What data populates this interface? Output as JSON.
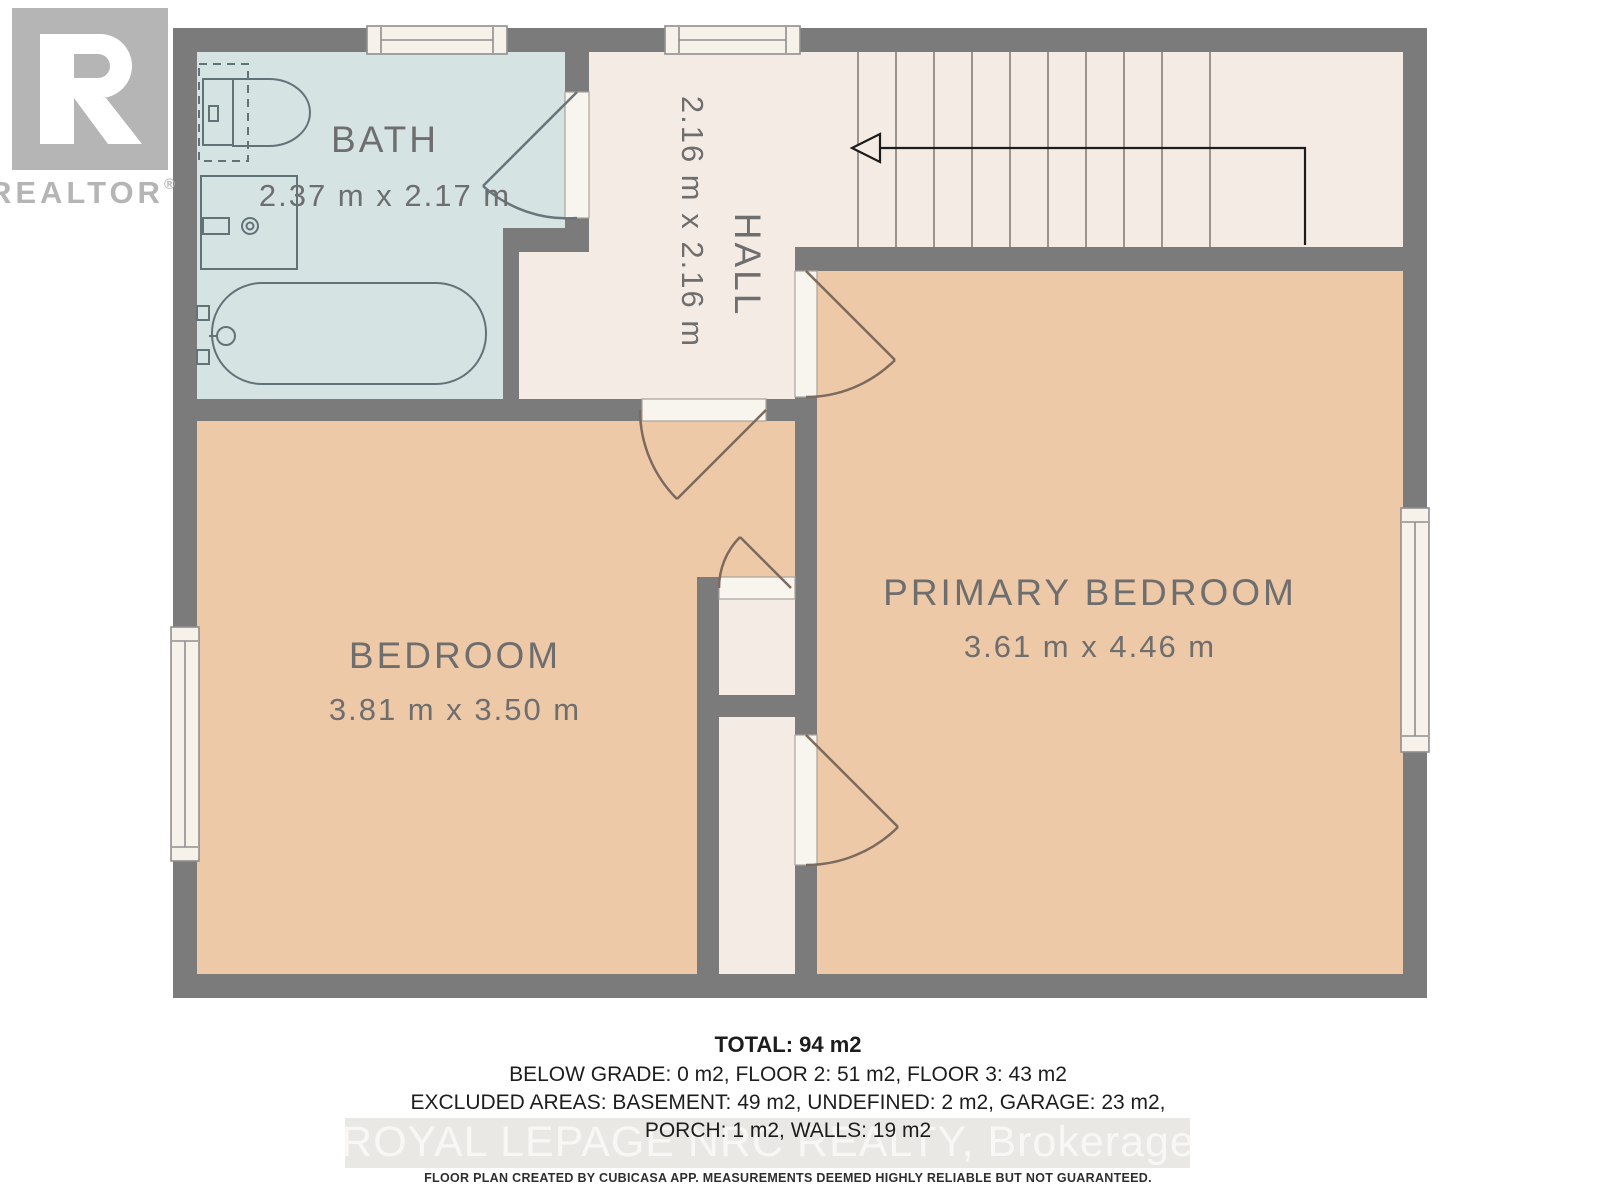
{
  "branding": {
    "logo_letter": "R",
    "logo_word": "REALTOR",
    "registered": "®"
  },
  "rooms": {
    "bath": {
      "label": "BATH",
      "dims": "2.37 m x 2.17 m",
      "fill": "#d5e3e3"
    },
    "hall": {
      "label": "HALL",
      "dims": "2.16 m x 2.16 m",
      "fill": "#f4ece4"
    },
    "bedroom": {
      "label": "BEDROOM",
      "dims": "3.81 m x 3.50 m",
      "fill": "#edc9a8"
    },
    "primary": {
      "label": "PRIMARY BEDROOM",
      "dims": "3.61 m x 4.46 m",
      "fill": "#edc9a8"
    }
  },
  "summary": {
    "total": "TOTAL: 94 m2",
    "floors": "BELOW GRADE: 0 m2, FLOOR 2: 51 m2, FLOOR 3: 43 m2",
    "excluded": "EXCLUDED AREAS: BASEMENT: 49 m2, UNDEFINED: 2 m2, GARAGE: 23 m2,",
    "excluded2": "PORCH: 1 m2, WALLS: 19 m2"
  },
  "watermark": "ROYAL LEPAGE NRC REALTY, Brokerage",
  "disclaimer": "FLOOR PLAN CREATED BY CUBICASA APP. MEASUREMENTS DEEMED HIGHLY RELIABLE BUT NOT GUARANTEED.",
  "colors": {
    "wall": "#7b7b7b",
    "bath_fill": "#d5e3e3",
    "floor_fill": "#f4ece4",
    "bedroom_fill": "#edc9a8",
    "label_text": "#6e6e6e",
    "fixture_stroke": "#627378",
    "door_stroke": "#7b6a5d",
    "arrow": "#1c1c1c",
    "logo_gray": "#b5b5b5",
    "watermark_text": "#fbfaf8"
  }
}
